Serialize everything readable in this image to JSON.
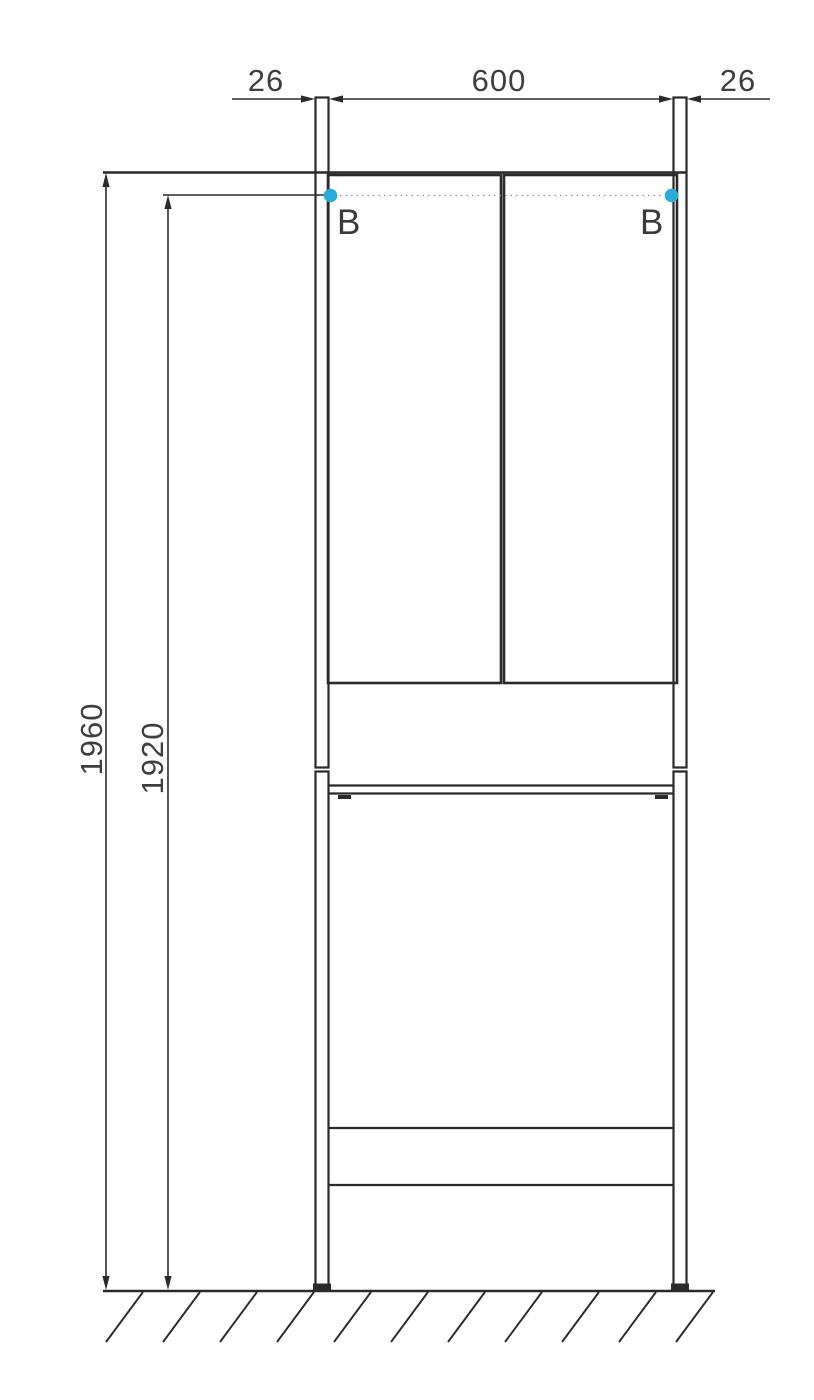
{
  "drawing": {
    "dimensions": {
      "side_panel_left": "26",
      "opening_width": "600",
      "side_panel_right": "26",
      "total_height": "1960",
      "mounting_height": "1920"
    },
    "mounting_points": {
      "left_label": "B",
      "right_label": "B"
    },
    "colors": {
      "line": "#2a2a2a",
      "text": "#3e3e3e",
      "accent_dot": "#29add8",
      "dotted_line": "#909090"
    }
  }
}
